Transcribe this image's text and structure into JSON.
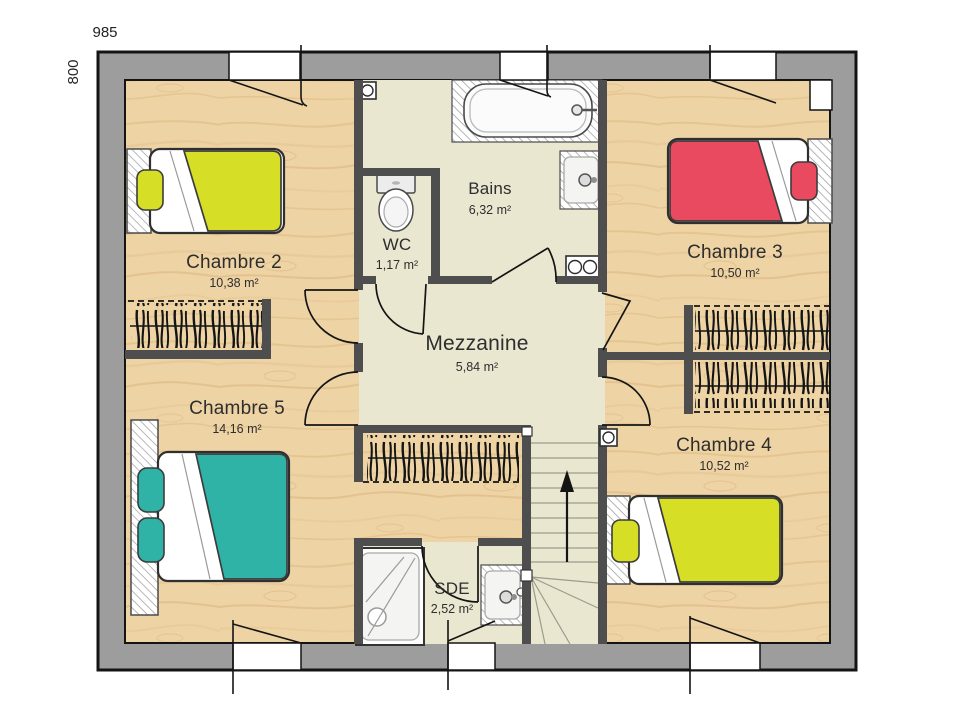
{
  "plan": {
    "dimensions": {
      "width_label": "985",
      "height_label": "800"
    },
    "rooms": [
      {
        "name": "Chambre 2",
        "area": "10,38 m²"
      },
      {
        "name": "Chambre 3",
        "area": "10,50 m²"
      },
      {
        "name": "Chambre 4",
        "area": "10,52 m²"
      },
      {
        "name": "Chambre 5",
        "area": "14,16 m²"
      },
      {
        "name": "Mezzanine",
        "area": "5,84 m²"
      },
      {
        "name": "Bains",
        "area": "6,32 m²"
      },
      {
        "name": "WC",
        "area": "1,17 m²"
      },
      {
        "name": "SDE",
        "area": "2,52 m²"
      }
    ],
    "fixtures": [
      "bathtub",
      "washbasin",
      "toilet",
      "shower",
      "washbasin",
      "staircase-up-arrow",
      "wardrobe-rail",
      "wardrobe-rail",
      "wardrobe-rail",
      "wardrobe-rail",
      "vent-box",
      "vent-box",
      "double-socket",
      "single-bed",
      "single-bed",
      "single-bed",
      "double-bed"
    ],
    "palette": {
      "outer_wall": "#9d9d9d",
      "inner_wall": "#4e4e4e",
      "outline": "#141414",
      "floor_wood": "#eed3a4",
      "floor_tile": "#eae7d1",
      "bed_yellow": "#d6de26",
      "bed_red": "#ea4a5f",
      "bed_teal": "#2eb3a6"
    }
  }
}
